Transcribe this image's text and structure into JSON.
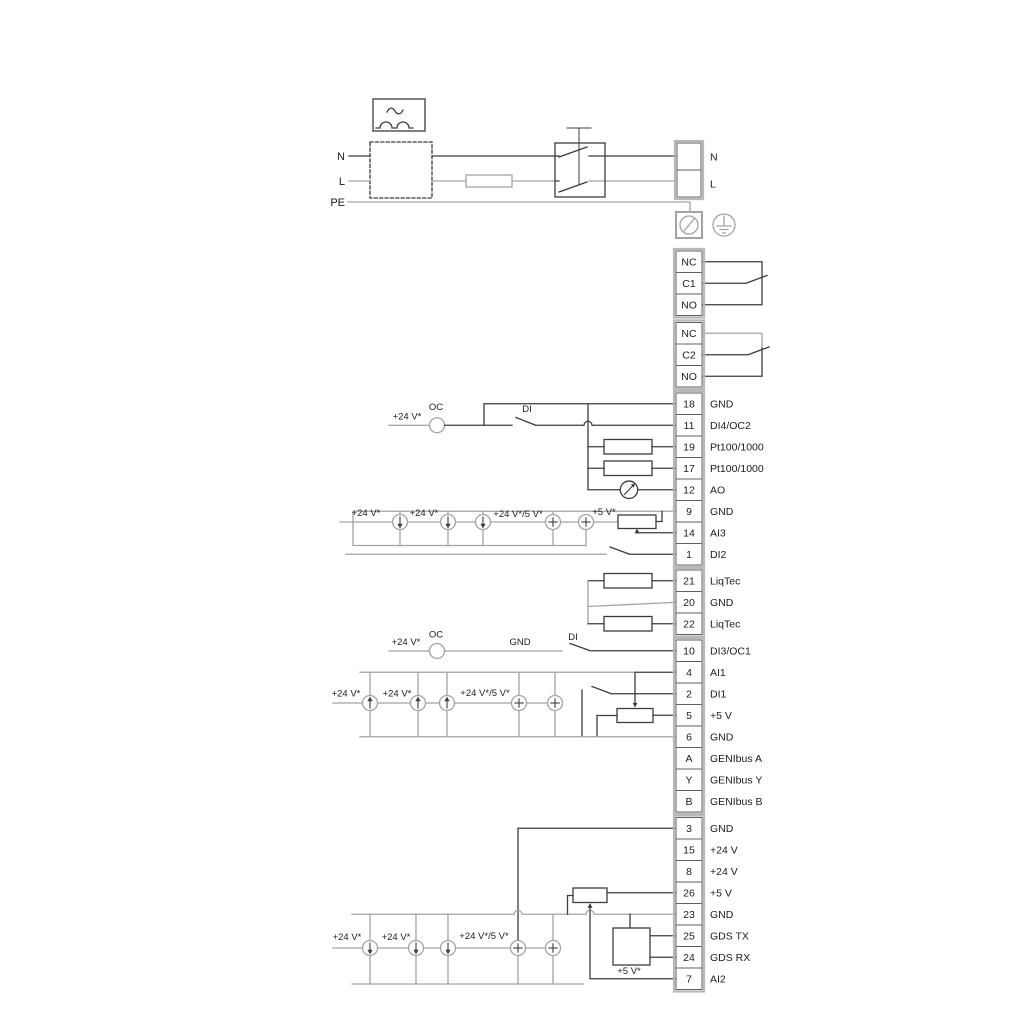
{
  "power": {
    "n": "N",
    "l": "L",
    "pe": "PE"
  },
  "terminals": {
    "mains": [
      {
        "id": "",
        "label": "N"
      },
      {
        "id": "",
        "label": "L"
      }
    ],
    "relay1": [
      {
        "id": "NC",
        "label": ""
      },
      {
        "id": "C1",
        "label": ""
      },
      {
        "id": "NO",
        "label": ""
      }
    ],
    "relay2": [
      {
        "id": "NC",
        "label": ""
      },
      {
        "id": "C2",
        "label": ""
      },
      {
        "id": "NO",
        "label": ""
      }
    ],
    "groupA": [
      {
        "id": "18",
        "label": "GND"
      },
      {
        "id": "11",
        "label": "DI4/OC2"
      },
      {
        "id": "19",
        "label": "Pt100/1000"
      },
      {
        "id": "17",
        "label": "Pt100/1000"
      },
      {
        "id": "12",
        "label": "AO"
      },
      {
        "id": "9",
        "label": "GND"
      },
      {
        "id": "14",
        "label": "AI3"
      },
      {
        "id": "1",
        "label": "DI2"
      }
    ],
    "liqtec": [
      {
        "id": "21",
        "label": "LiqTec"
      },
      {
        "id": "20",
        "label": "GND"
      },
      {
        "id": "22",
        "label": "LiqTec"
      }
    ],
    "groupC": [
      {
        "id": "10",
        "label": "DI3/OC1"
      },
      {
        "id": "4",
        "label": "AI1"
      },
      {
        "id": "2",
        "label": "DI1"
      },
      {
        "id": "5",
        "label": "+5 V"
      },
      {
        "id": "6",
        "label": "GND"
      },
      {
        "id": "A",
        "label": "GENIbus A"
      },
      {
        "id": "Y",
        "label": "GENIbus Y"
      },
      {
        "id": "B",
        "label": "GENIbus B"
      }
    ],
    "groupD": [
      {
        "id": "3",
        "label": "GND"
      },
      {
        "id": "15",
        "label": "+24 V"
      },
      {
        "id": "8",
        "label": "+24 V"
      },
      {
        "id": "26",
        "label": "+5 V"
      },
      {
        "id": "23",
        "label": "GND"
      },
      {
        "id": "25",
        "label": "GDS TX"
      },
      {
        "id": "24",
        "label": "GDS RX"
      },
      {
        "id": "7",
        "label": "AI2"
      }
    ]
  },
  "ann": {
    "r1": {
      "v24": "+24 V*",
      "oc": "OC",
      "di": "DI"
    },
    "r2": {
      "v24a": "+24 V*",
      "v24b": "+24 V*",
      "v245": "+24 V*/5 V*",
      "v5": "+5 V*"
    },
    "r10": {
      "v24": "+24 V*",
      "oc": "OC",
      "gnd": "GND",
      "di": "DI"
    },
    "r3": {
      "v24a": "+24 V*",
      "v24b": "+24 V*",
      "v245": "+24 V*/5 V*"
    },
    "r4": {
      "v24a": "+24 V*",
      "v24b": "+24 V*",
      "v245": "+24 V*/5 V*",
      "v5": "+5 V*"
    }
  },
  "colors": {
    "wire_dark": "#3c3c3c",
    "wire_gray": "#a3a3a3",
    "text": "#1c1c1c",
    "background": "#ffffff"
  }
}
